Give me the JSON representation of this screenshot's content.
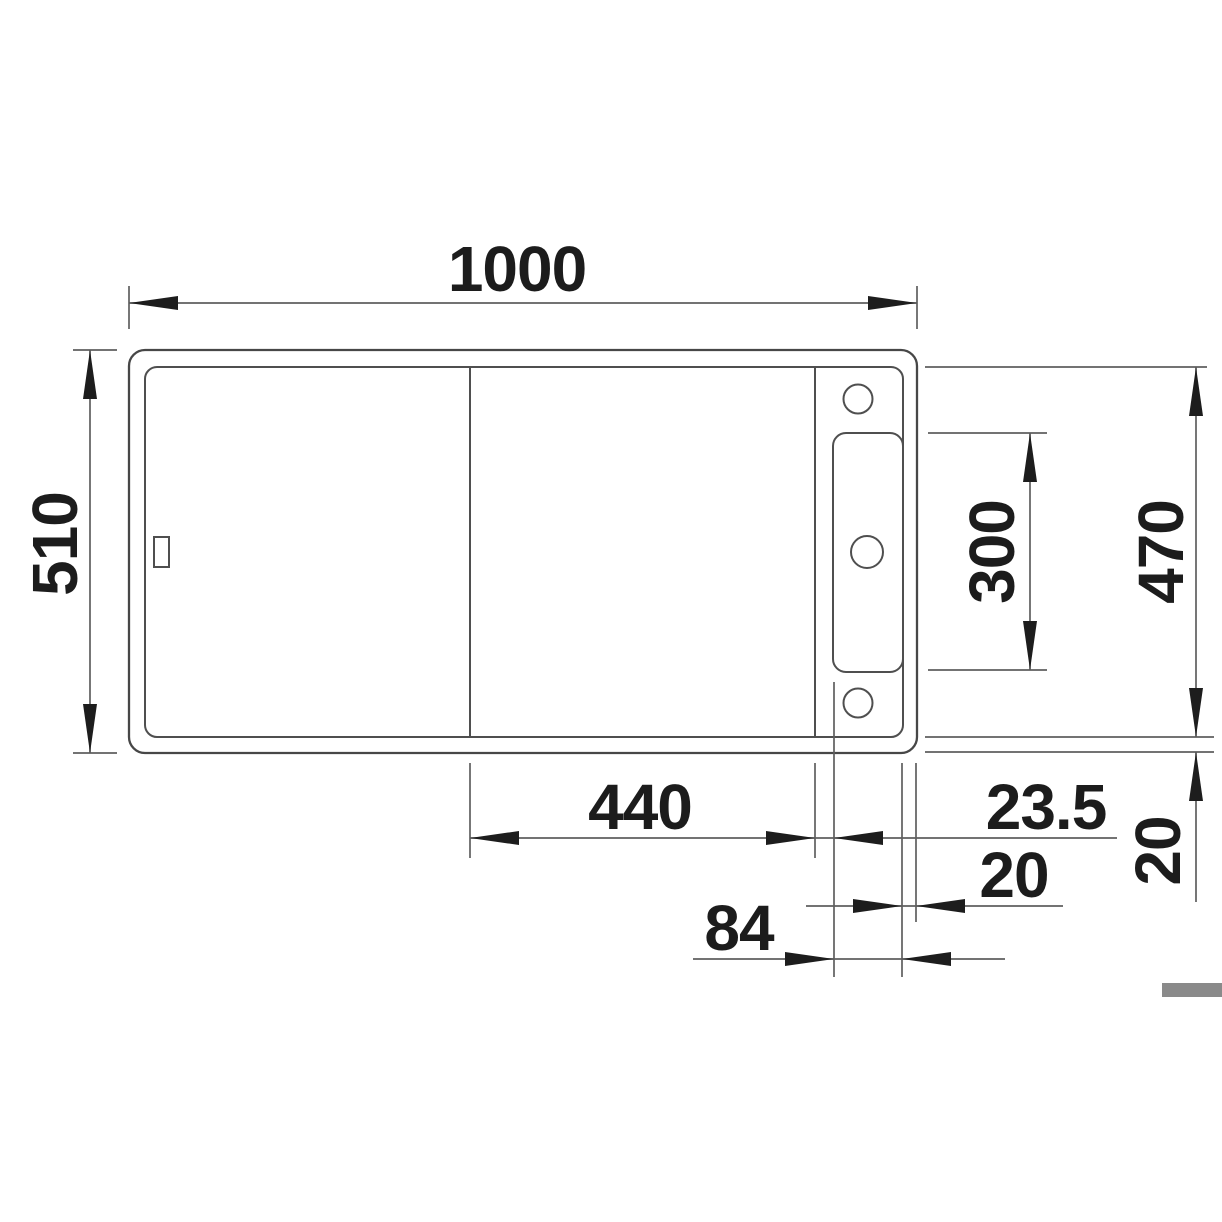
{
  "drawing": {
    "description": "Kitchen sink installation technical drawing, plan (top) view with dimension lines",
    "unit": "mm",
    "colors": {
      "background": "#ffffff",
      "sink_outline": "#474747",
      "dimension_line": "#5f5f5f",
      "arrow": "#1d1d1d",
      "text": "#1c1c1c",
      "scrollbar": "#8a8a8a"
    },
    "dimensions": {
      "overall_width": "1000",
      "overall_depth": "510",
      "inner_depth": "470",
      "rail_cutout_length": "300",
      "bowl_width": "440",
      "bowl_to_rail_gap": "23.5",
      "rail_to_edge_gap": "20",
      "rail_zone_width": "84",
      "rim_width": "20"
    }
  }
}
